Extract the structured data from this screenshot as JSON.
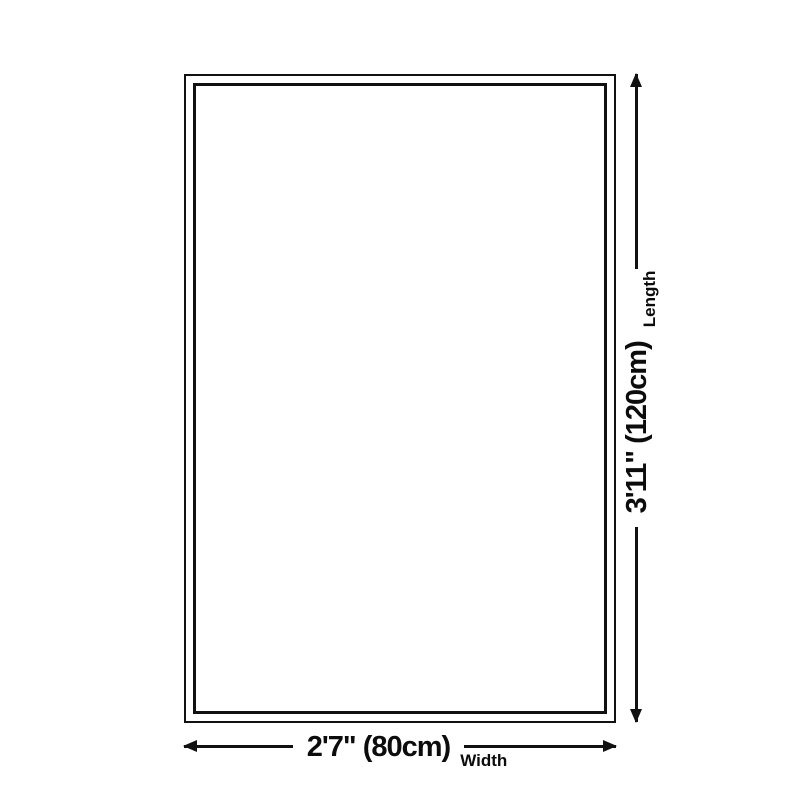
{
  "diagram": {
    "background_color": "#ffffff",
    "line_color": "#111111",
    "text_color": "#0c0c0c",
    "width_dimension": {
      "value": "2'7\" (80cm)",
      "axis_label": "Width"
    },
    "length_dimension": {
      "value": "3'11\" (120cm)",
      "axis_label": "Length"
    }
  }
}
